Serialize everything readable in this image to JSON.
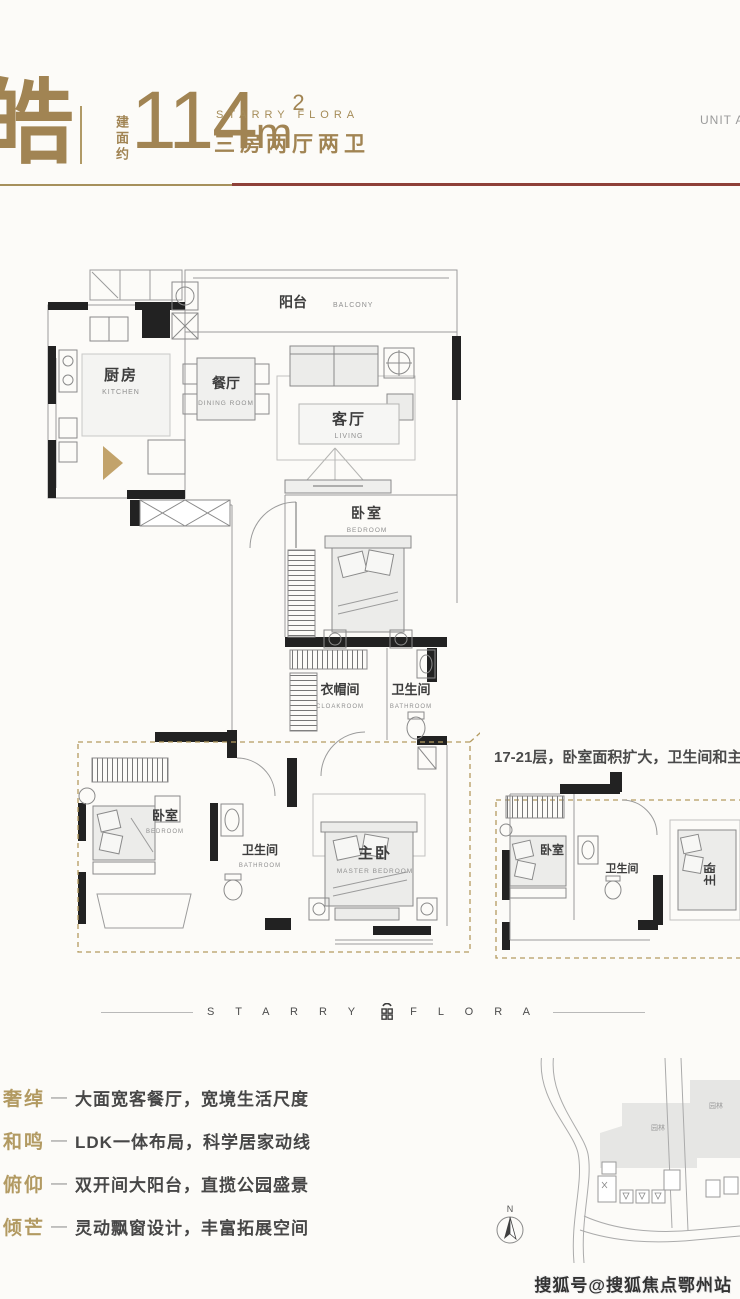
{
  "header": {
    "name_char": "皓",
    "area_label_vertical": "建面约",
    "area_value": "114",
    "area_unit": "m",
    "area_exponent": "2",
    "brand_en": "STARRY FLORA",
    "layout_type": "三房两厅两卫",
    "unit_area_label": "UNIT AREA"
  },
  "floorplan": {
    "rooms": {
      "balcony_cn": "阳台",
      "balcony_en": "BALCONY",
      "kitchen_cn": "厨房",
      "kitchen_en": "KITCHEN",
      "dining_cn": "餐厅",
      "dining_en": "DINING ROOM",
      "living_cn": "客厅",
      "living_en": "LIVING",
      "bedroom_cn": "卧室",
      "bedroom_en": "BEDROOM",
      "cloakroom_cn": "衣帽间",
      "cloakroom_en": "CLOAKROOM",
      "bathroom_cn": "卫生间",
      "bathroom_en": "BATHROOM",
      "bedroom2_cn": "卧室",
      "bedroom2_en": "BEDROOM",
      "bathroom2_cn": "卫生间",
      "bathroom2_en": "BATHROOM",
      "master_cn": "主卧",
      "master_en": "MASTER BEDROOM"
    },
    "variant_note": "17-21层，卧室面积扩大，卫生间和主卧",
    "variant_rooms": {
      "bedroom_cn": "卧室",
      "bathroom_cn": "卫生间",
      "master_cn": "主卧"
    }
  },
  "brand_divider": {
    "left_word": "S T A R R Y",
    "right_word": "F L O R A"
  },
  "features": {
    "dash": "—",
    "items": [
      {
        "term": "奢绰",
        "desc": "大面宽客餐厅，宽境生活尺度"
      },
      {
        "term": "和鸣",
        "desc": "LDK一体布局，科学居家动线"
      },
      {
        "term": "俯仰",
        "desc": "双开间大阳台，直揽公园盛景"
      },
      {
        "term": "倾芒",
        "desc": "灵动飘窗设计，丰富拓展空间"
      }
    ]
  },
  "map": {
    "north_label": "N",
    "park_label": "园林"
  },
  "watermark": "搜狐号@搜狐焦点鄂州站",
  "colors": {
    "gold": "#a18453",
    "dark_red": "#8e4038",
    "wall_black": "#222222",
    "dash_gold": "#b49b60"
  }
}
